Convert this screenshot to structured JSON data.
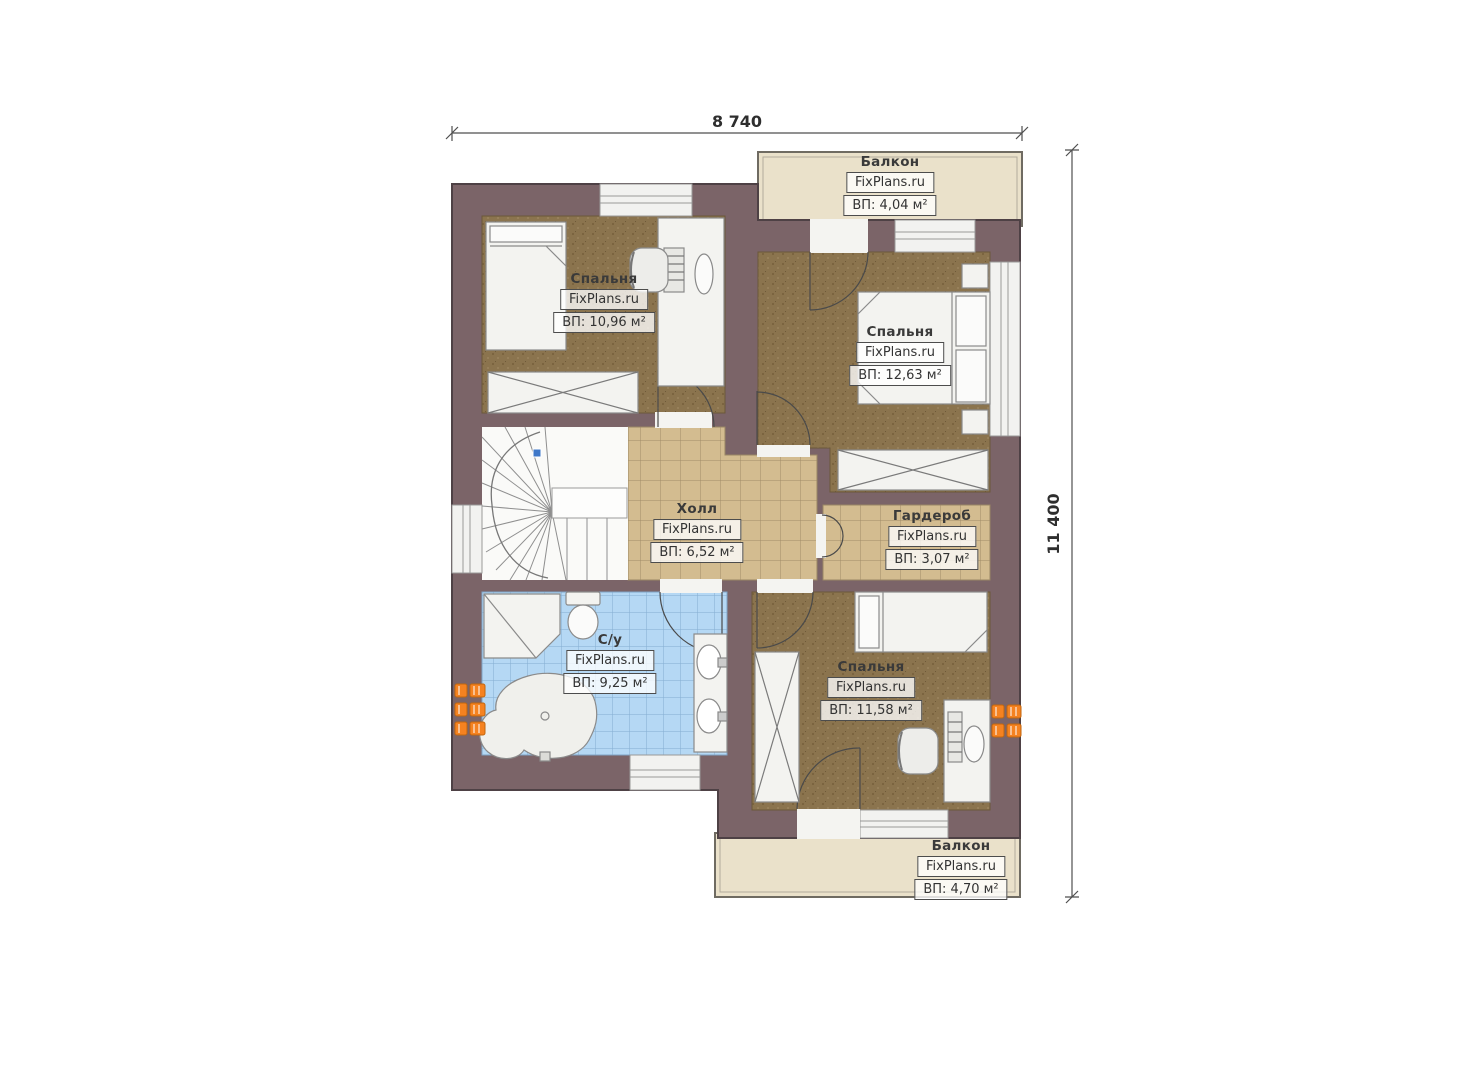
{
  "plan": {
    "title_watermark": "FixPlans.ru",
    "dimensions": {
      "width_label": "8 740",
      "height_label": "11 400"
    },
    "rooms": {
      "balcony_top": {
        "name": "Балкон",
        "area": "ВП: 4,04 м²"
      },
      "bedroom_top_left": {
        "name": "Спальня",
        "area": "ВП: 10,96 м²"
      },
      "bedroom_top_right": {
        "name": "Спальня",
        "area": "ВП: 12,63 м²"
      },
      "hall": {
        "name": "Холл",
        "area": "ВП: 6,52 м²"
      },
      "wardrobe": {
        "name": "Гардероб",
        "area": "ВП: 3,07 м²"
      },
      "bathroom": {
        "name": "С/у",
        "area": "ВП: 9,25 м²"
      },
      "bedroom_bottom_right": {
        "name": "Спальня",
        "area": "ВП: 11,58 м²"
      },
      "balcony_bottom": {
        "name": "Балкон",
        "area": "ВП: 4,70 м²"
      }
    },
    "colors": {
      "wall": "#7b6468",
      "bedroom_floor": "#8b744e",
      "hall_floor": "#d3bc90",
      "bathroom_floor": "#b5d8f4",
      "balcony_floor": "#eae1ca",
      "radiator": "#f58220",
      "stair_marker": "#3f78c8"
    }
  }
}
